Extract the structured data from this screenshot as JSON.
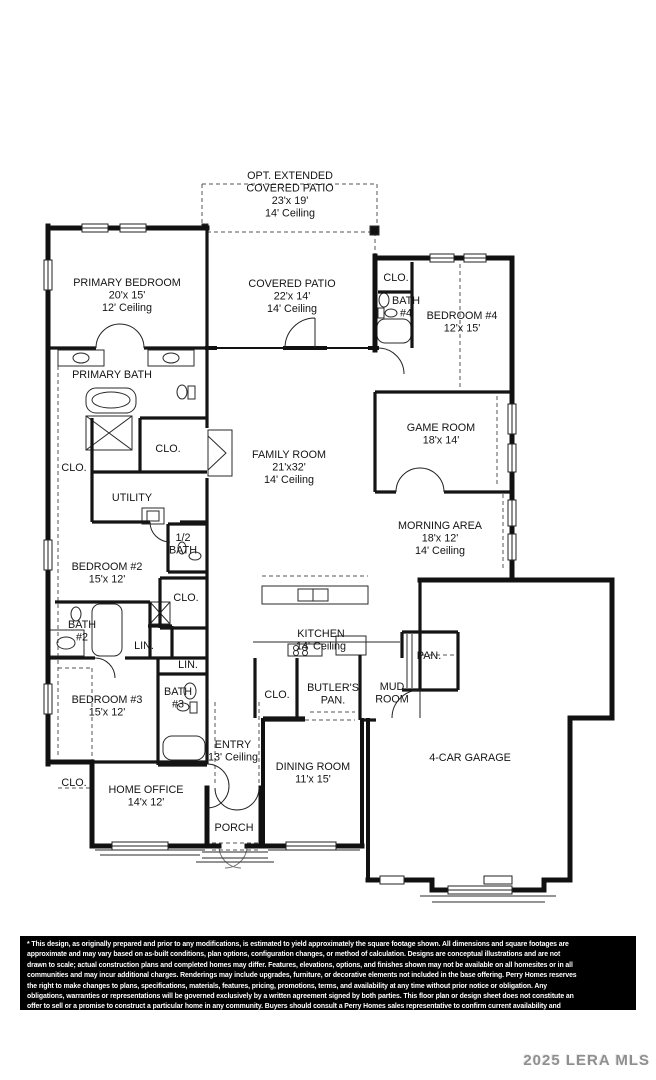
{
  "watermark": "2025 LERA MLS",
  "disclaimer": {
    "lines": [
      "* This design, as originally prepared and prior to any modifications, is estimated to yield approximately the square footage shown. All dimensions and square footages are",
      "approximate and may vary based on as-built conditions, plan options, configuration changes, or method of calculation. Designs are conceptual illustrations and are not",
      "drawn to scale; actual construction plans and completed homes may differ. Features, elevations, options, and finishes shown may not be available on all homesites or in all",
      "communities and may incur additional charges. Renderings may include upgrades, furniture, or decorative elements not included in the base offering. Perry Homes reserves",
      "the right to make changes to plans, specifications, materials, features, pricing, promotions, terms, and availability at any time without prior notice or obligation. Any",
      "obligations, warranties or representations will be governed exclusively by a written agreement signed by both parties. This floor plan or design sheet does not constitute an",
      "offer to sell or a promise to construct a particular home in any community. Buyers should consult a Perry Homes sales representative to confirm current availability and"
    ]
  },
  "floor_plan": {
    "rooms": [
      {
        "id": "opt-extended-covered-patio",
        "lines": [
          "OPT. EXTENDED",
          "COVERED PATIO",
          "23'x 19'",
          "14' Ceiling"
        ],
        "x": 290,
        "y": 179
      },
      {
        "id": "primary-bedroom",
        "lines": [
          "PRIMARY BEDROOM",
          "20'x 15'",
          "12' Ceiling"
        ],
        "x": 127,
        "y": 286
      },
      {
        "id": "covered-patio",
        "lines": [
          "COVERED PATIO",
          "22'x 14'",
          "14' Ceiling"
        ],
        "x": 292,
        "y": 287
      },
      {
        "id": "clo-bath4",
        "lines": [
          "CLO."
        ],
        "x": 396,
        "y": 281
      },
      {
        "id": "bath-4",
        "lines": [
          "BATH",
          "#4"
        ],
        "x": 406,
        "y": 304
      },
      {
        "id": "bedroom-4",
        "lines": [
          "BEDROOM #4",
          "12'x 15'"
        ],
        "x": 462,
        "y": 319
      },
      {
        "id": "primary-bath",
        "lines": [
          "PRIMARY BATH"
        ],
        "x": 112,
        "y": 378
      },
      {
        "id": "game-room",
        "lines": [
          "GAME ROOM",
          "18'x 14'"
        ],
        "x": 441,
        "y": 431
      },
      {
        "id": "clo-primary",
        "lines": [
          "CLO."
        ],
        "x": 168,
        "y": 452
      },
      {
        "id": "family-room",
        "lines": [
          "FAMILY ROOM",
          "21'x32'",
          "14' Ceiling"
        ],
        "x": 289,
        "y": 458
      },
      {
        "id": "clo-left",
        "lines": [
          "CLO."
        ],
        "x": 74,
        "y": 471
      },
      {
        "id": "utility",
        "lines": [
          "UTILITY"
        ],
        "x": 132,
        "y": 501
      },
      {
        "id": "morning-area",
        "lines": [
          "MORNING AREA",
          "18'x 12'",
          "14' Ceiling"
        ],
        "x": 440,
        "y": 529
      },
      {
        "id": "half-bath",
        "lines": [
          "1/2",
          "BATH"
        ],
        "x": 183,
        "y": 541
      },
      {
        "id": "bedroom-2",
        "lines": [
          "BEDROOM #2",
          "15'x 12'"
        ],
        "x": 107,
        "y": 570
      },
      {
        "id": "clo-bedroom2",
        "lines": [
          "CLO."
        ],
        "x": 186,
        "y": 601
      },
      {
        "id": "bath-2",
        "lines": [
          "BATH",
          "#2"
        ],
        "x": 82,
        "y": 628
      },
      {
        "id": "kitchen",
        "lines": [
          "KITCHEN",
          "14' Ceiling"
        ],
        "x": 321,
        "y": 637
      },
      {
        "id": "lin-bath2",
        "lines": [
          "LIN."
        ],
        "x": 144,
        "y": 649
      },
      {
        "id": "pan",
        "lines": [
          "PAN."
        ],
        "x": 429,
        "y": 659
      },
      {
        "id": "lin-bath3",
        "lines": [
          "LIN."
        ],
        "x": 188,
        "y": 668
      },
      {
        "id": "bath-3",
        "lines": [
          "BATH",
          "#3"
        ],
        "x": 178,
        "y": 695
      },
      {
        "id": "mud-room",
        "lines": [
          "MUD",
          "ROOM"
        ],
        "x": 392,
        "y": 690
      },
      {
        "id": "butlers-pan",
        "lines": [
          "BUTLER'S",
          "PAN."
        ],
        "x": 333,
        "y": 691
      },
      {
        "id": "clo-butler",
        "lines": [
          "CLO."
        ],
        "x": 277,
        "y": 698
      },
      {
        "id": "bedroom-3",
        "lines": [
          "BEDROOM #3",
          "15'x 12'"
        ],
        "x": 107,
        "y": 703
      },
      {
        "id": "entry",
        "lines": [
          "ENTRY",
          "13' Ceiling"
        ],
        "x": 233,
        "y": 748
      },
      {
        "id": "garage",
        "lines": [
          "4-CAR GARAGE"
        ],
        "x": 470,
        "y": 761
      },
      {
        "id": "dining-room",
        "lines": [
          "DINING ROOM",
          "11'x 15'"
        ],
        "x": 313,
        "y": 770
      },
      {
        "id": "clo-bedroom3",
        "lines": [
          "CLO."
        ],
        "x": 74,
        "y": 786
      },
      {
        "id": "home-office",
        "lines": [
          "HOME OFFICE",
          "14'x 12'"
        ],
        "x": 146,
        "y": 793
      },
      {
        "id": "porch",
        "lines": [
          "PORCH"
        ],
        "x": 234,
        "y": 831
      }
    ]
  }
}
